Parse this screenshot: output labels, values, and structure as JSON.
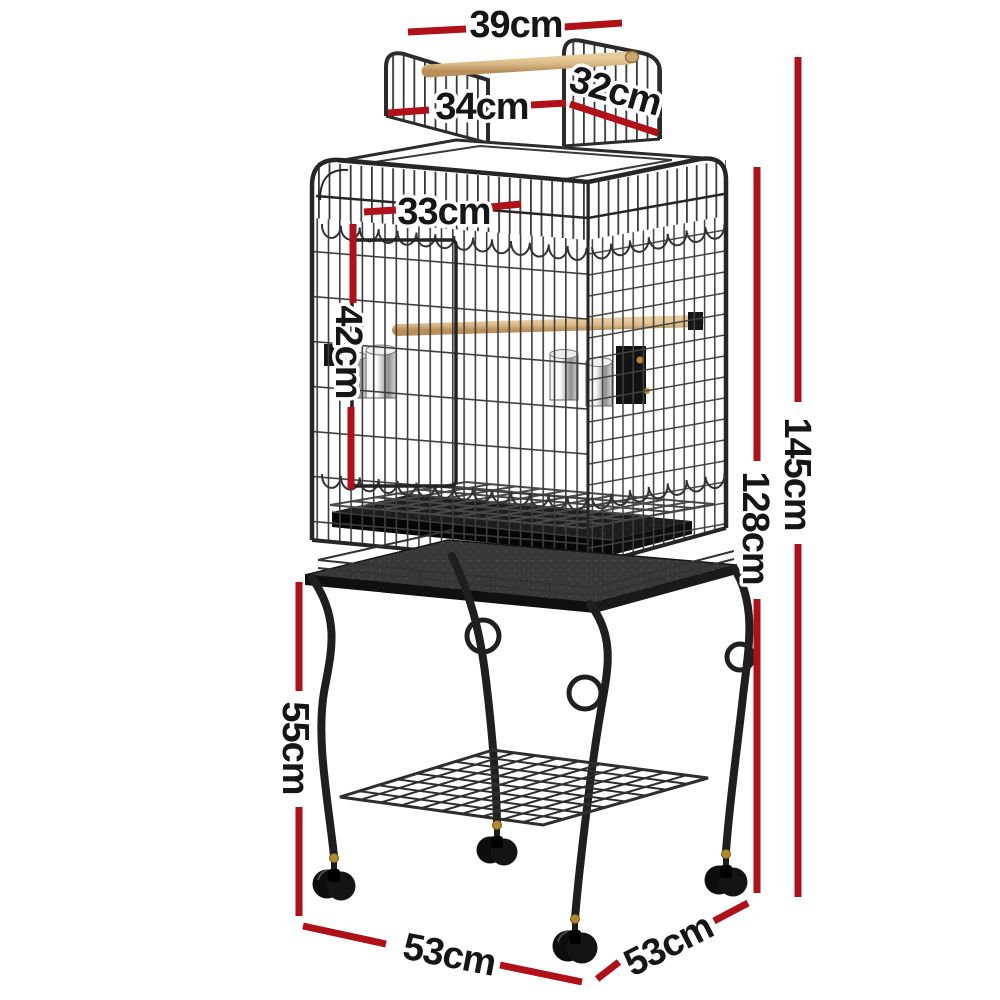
{
  "image": {
    "description": "Open play-top bird cage with wooden perches, feeder cups, pull-out tray and wheeled stand with storage shelf, annotated with product dimensions",
    "background": "#ffffff"
  },
  "colors": {
    "dimension_line": "#b01118",
    "label_text": "#161616",
    "label_halo": "#ffffff",
    "cage_metal": "#2e2e2e",
    "wood_perch": "#d9b887",
    "steel_cup": "#c9c9c9",
    "stand_metal": "#1f1f1f"
  },
  "dimension_labels": {
    "top_perch_width": "39cm",
    "left_roof_panel_width": "34cm",
    "right_roof_panel_width": "32cm",
    "roof_opening_width": "33cm",
    "upper_front_height": "42cm",
    "total_height": "145cm",
    "cage_height": "128cm",
    "stand_clearance_height": "55cm",
    "base_width_front": "53cm",
    "base_depth_side": "53cm"
  }
}
